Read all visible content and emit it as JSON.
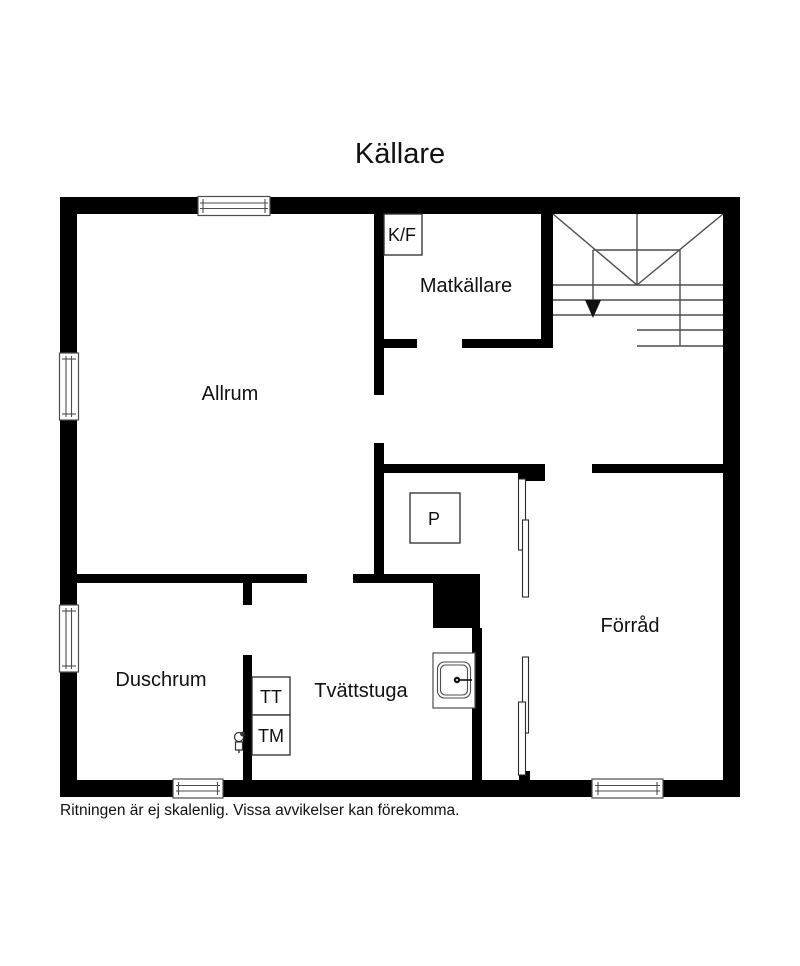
{
  "title": "Källare",
  "disclaimer": "Ritningen är ej skalenlig. Vissa avvikelser kan förekomma.",
  "rooms": {
    "allrum": "Allrum",
    "matkallare": "Matkällare",
    "duschrum": "Duschrum",
    "tvattstuga": "Tvättstuga",
    "forrad": "Förråd"
  },
  "fixtures": {
    "kf": "K/F",
    "p": "P",
    "tt": "TT",
    "tm": "TM"
  },
  "colors": {
    "wall": "#000000",
    "thin_line": "#4d4d4d",
    "background": "#ffffff",
    "text": "#111111"
  }
}
